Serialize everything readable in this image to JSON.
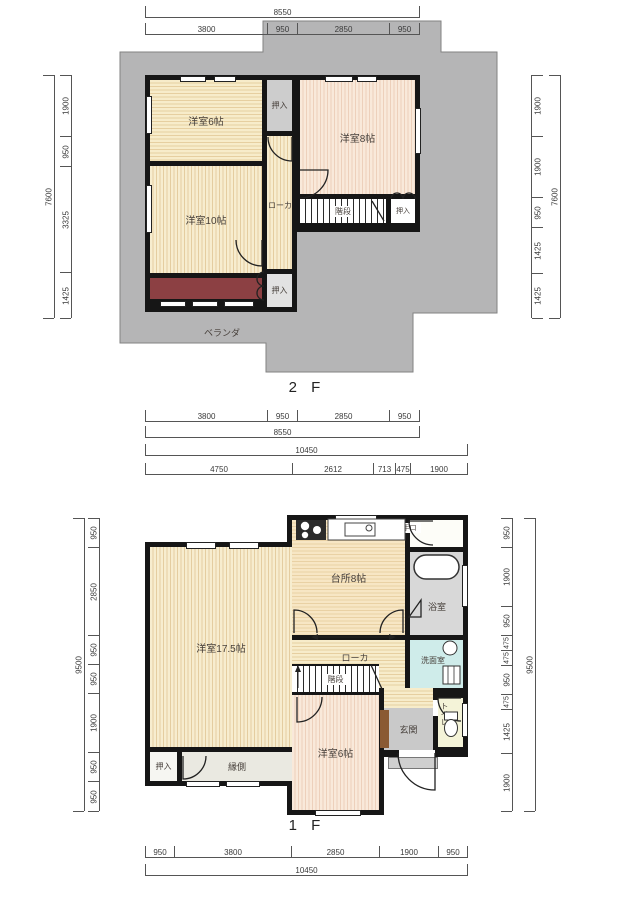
{
  "f2": {
    "label": "2 F",
    "rooms": {
      "room6": "洋室6帖",
      "room8": "洋室8帖",
      "room10": "洋室10帖",
      "corridor": "ローカ",
      "stairs": "階段",
      "closet": "押入",
      "veranda": "ベランダ"
    },
    "dims": {
      "top_total": "8550",
      "top": [
        "3800",
        "950",
        "2850",
        "950"
      ],
      "bottom": [
        "3800",
        "950",
        "2850",
        "950"
      ],
      "bottom_total": "8550",
      "left": [
        "1900",
        "950",
        "3325",
        "1425"
      ],
      "left_total": "7600",
      "right": [
        "1900",
        "1900",
        "950",
        "1425",
        "1425"
      ],
      "right_total": "7600"
    }
  },
  "f1": {
    "label": "1 F",
    "rooms": {
      "living": "洋室17.5帖",
      "kitchen": "台所8帖",
      "bath": "浴室",
      "wash": "洗面室",
      "corridor": "ローカ",
      "stairs": "階段",
      "room6": "洋室6帖",
      "entrance": "玄関",
      "toilet": "トイレ",
      "closet": "押入",
      "engawa": "縁側",
      "backdoor": "勝手口"
    },
    "dims": {
      "top_total": "10450",
      "top": [
        "4750",
        "2612",
        "713",
        "475",
        "1900"
      ],
      "bottom": [
        "950",
        "3800",
        "2850",
        "1900",
        "950"
      ],
      "bottom_total": "10450",
      "left": [
        "950",
        "2850",
        "950",
        "950",
        "1900",
        "950",
        "950"
      ],
      "left_total": "9500",
      "right": [
        "950",
        "1900",
        "950",
        "475",
        "475",
        "950",
        "475",
        "1425",
        "1900"
      ],
      "right_total": "9500"
    }
  },
  "colors": {
    "roof_gray": "#b5b5b6",
    "wall_black": "#161616",
    "tatami_cream": "#f7edcf",
    "tatami_pink": "#f9e9da",
    "veranda_red": "#8c4043",
    "entrance_gray": "#c9c9c9",
    "washroom_cyan": "#cfecea",
    "toilet_yellow": "#f4f3d8",
    "bath_gray": "#d8d8d8",
    "cabinet_brown": "#8a5a33"
  }
}
